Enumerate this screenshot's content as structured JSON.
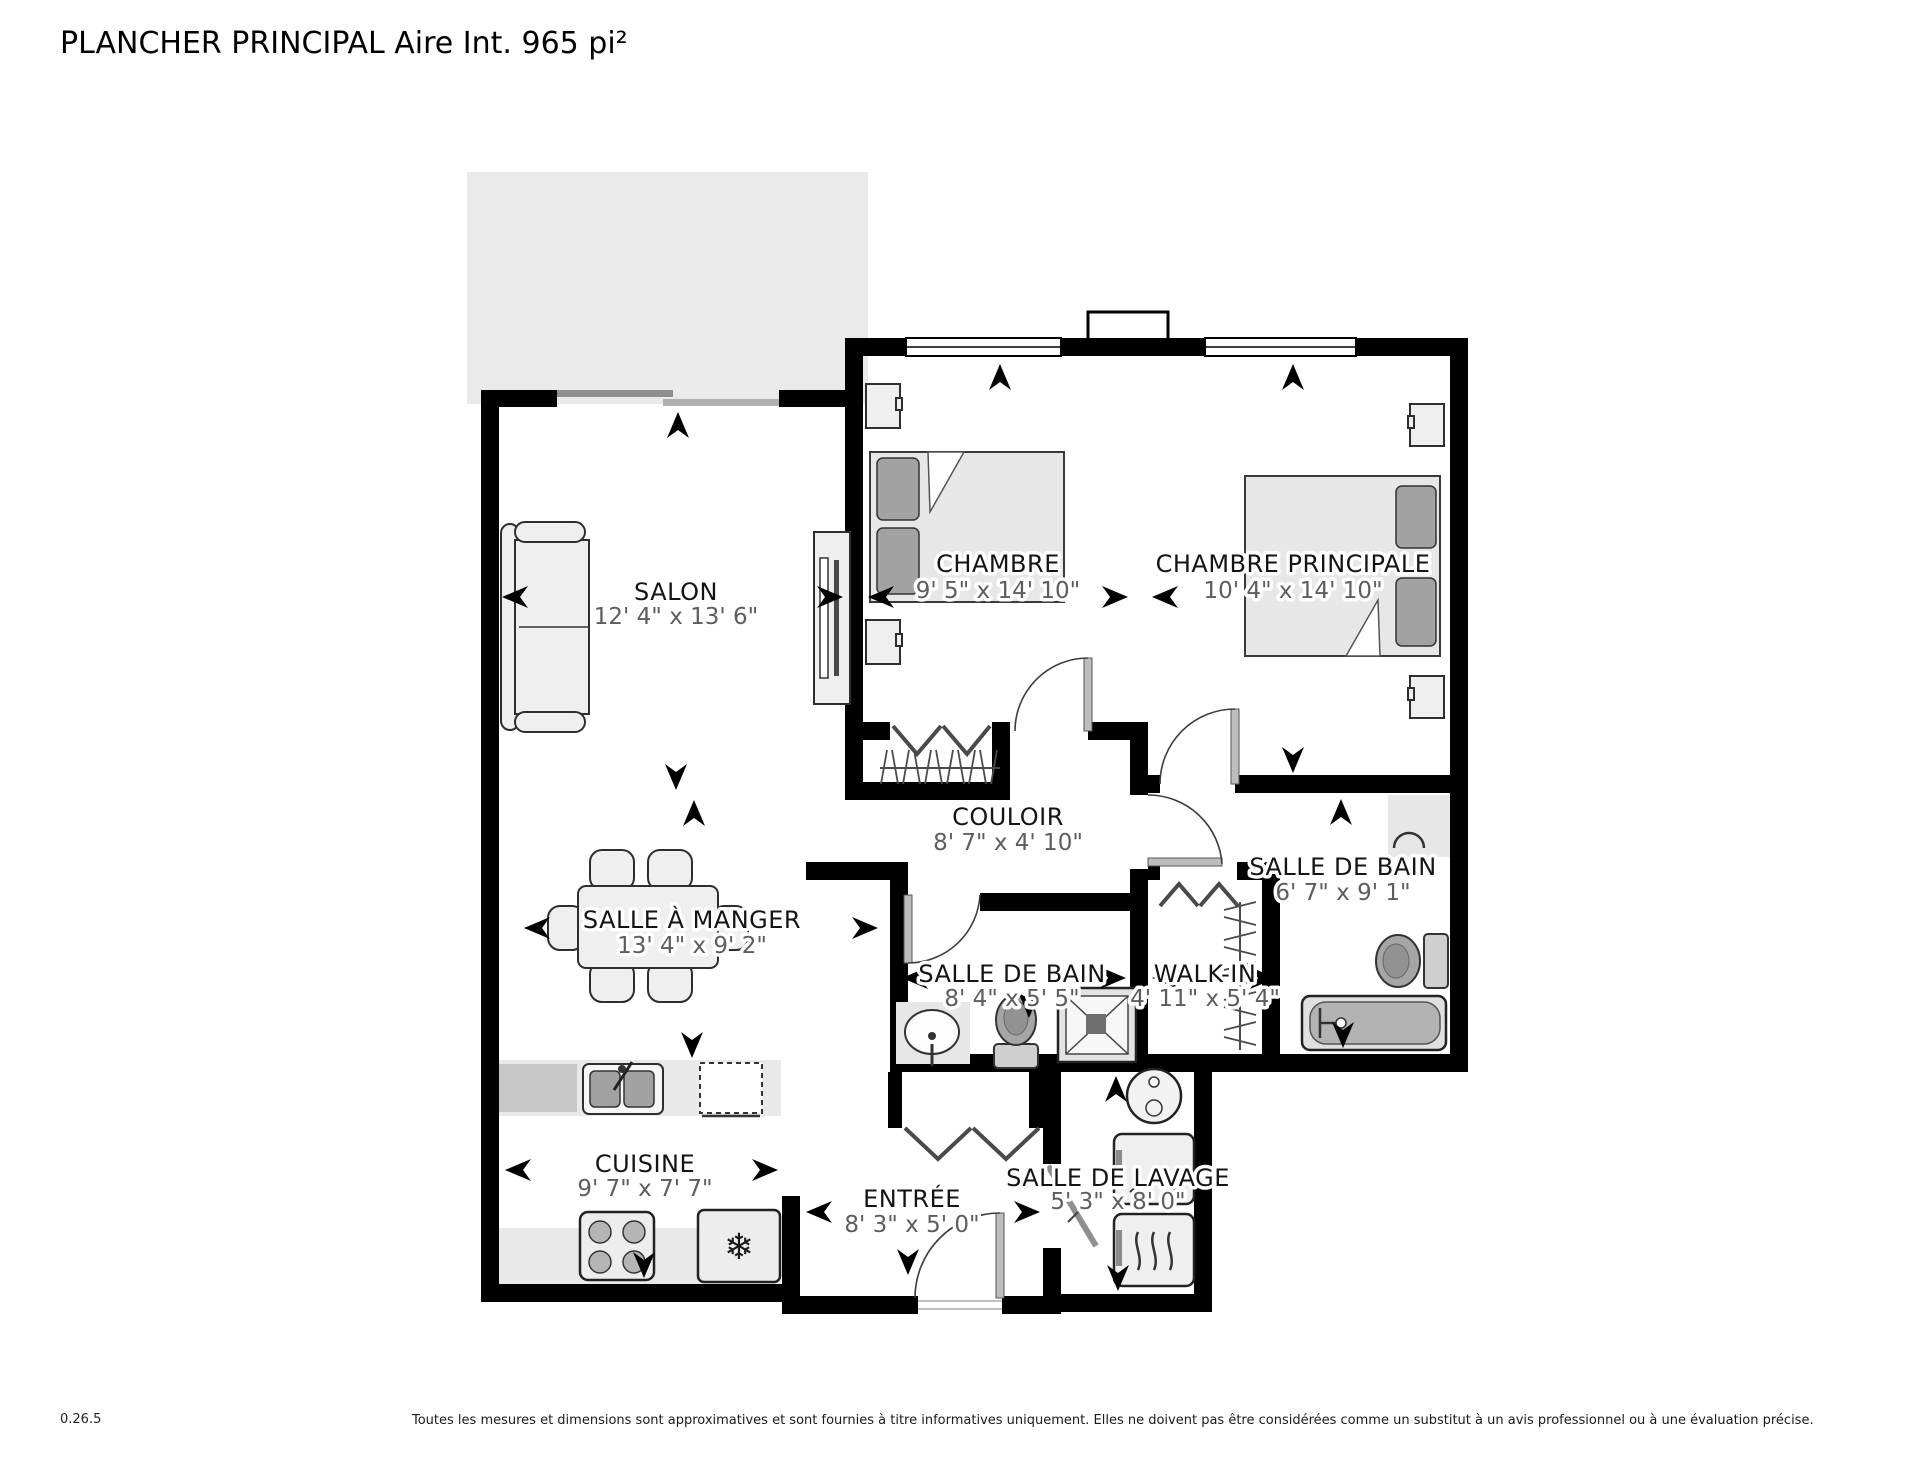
{
  "title": "PLANCHER PRINCIPAL Aire Int. 965 pi²",
  "floorplan": {
    "rooms": [
      {
        "name": "SALON",
        "dims": "12' 4\" x 13' 6\""
      },
      {
        "name": "CHAMBRE",
        "dims": "9' 5\" x 14' 10\""
      },
      {
        "name": "CHAMBRE PRINCIPALE",
        "dims": "10' 4\" x 14' 10\""
      },
      {
        "name": "COULOIR",
        "dims": "8' 7\" x 4' 10\""
      },
      {
        "name": "SALLE DE BAIN",
        "dims": "6' 7\" x 9' 1\""
      },
      {
        "name": "SALLE À MANGER",
        "dims": "13' 4\" x 9' 2\""
      },
      {
        "name": "SALLE DE BAIN",
        "dims": "8' 4\" x 5' 5\""
      },
      {
        "name": "WALK-IN",
        "dims": "4' 11\" x 5' 4\""
      },
      {
        "name": "CUISINE",
        "dims": "9' 7\" x 7' 7\""
      },
      {
        "name": "ENTRÉE",
        "dims": "8' 3\" x 5' 0\""
      },
      {
        "name": "SALLE DE LAVAGE",
        "dims": "5' 3\" x 8' 0\""
      }
    ]
  },
  "icons": {
    "fridge_icon": "❄"
  },
  "colors": {
    "wall": "#000000",
    "balcony": "#eaeaea",
    "furniture_fill": "#efefef",
    "accent_gray": "#a2a2a2",
    "dim_text": "#5d5d5d"
  },
  "footer": {
    "version": "0.26.5",
    "disclaimer": "Toutes les mesures et dimensions sont approximatives et sont fournies à titre informatives uniquement. Elles ne doivent pas être considérées comme un substitut à un avis professionnel ou à une évaluation précise."
  }
}
